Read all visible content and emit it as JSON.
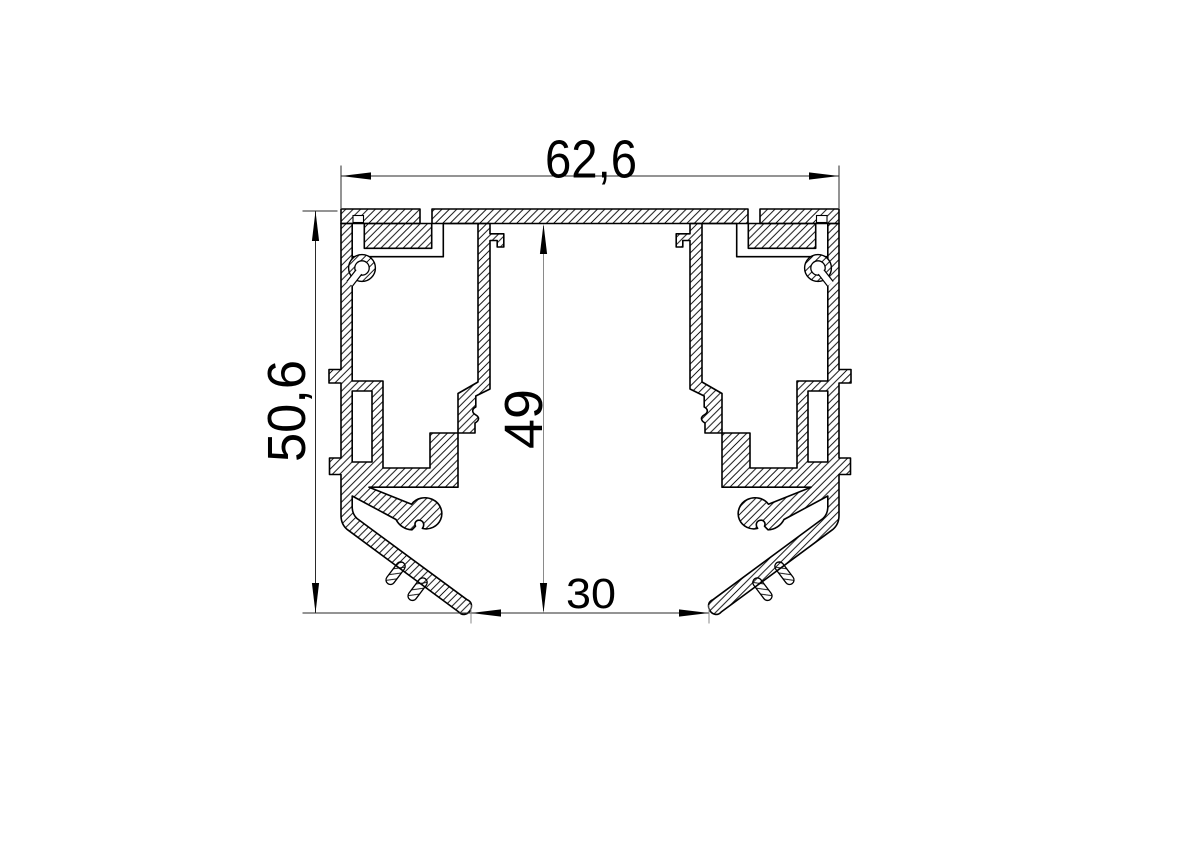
{
  "drawing": {
    "background": "#ffffff",
    "stroke_color": "#000000",
    "kind": "aluminium-profile-cross-section",
    "dimensions": {
      "top_width": "62,6",
      "left_height": "50,6",
      "inner_height": "49",
      "bottom_width": "30"
    }
  }
}
